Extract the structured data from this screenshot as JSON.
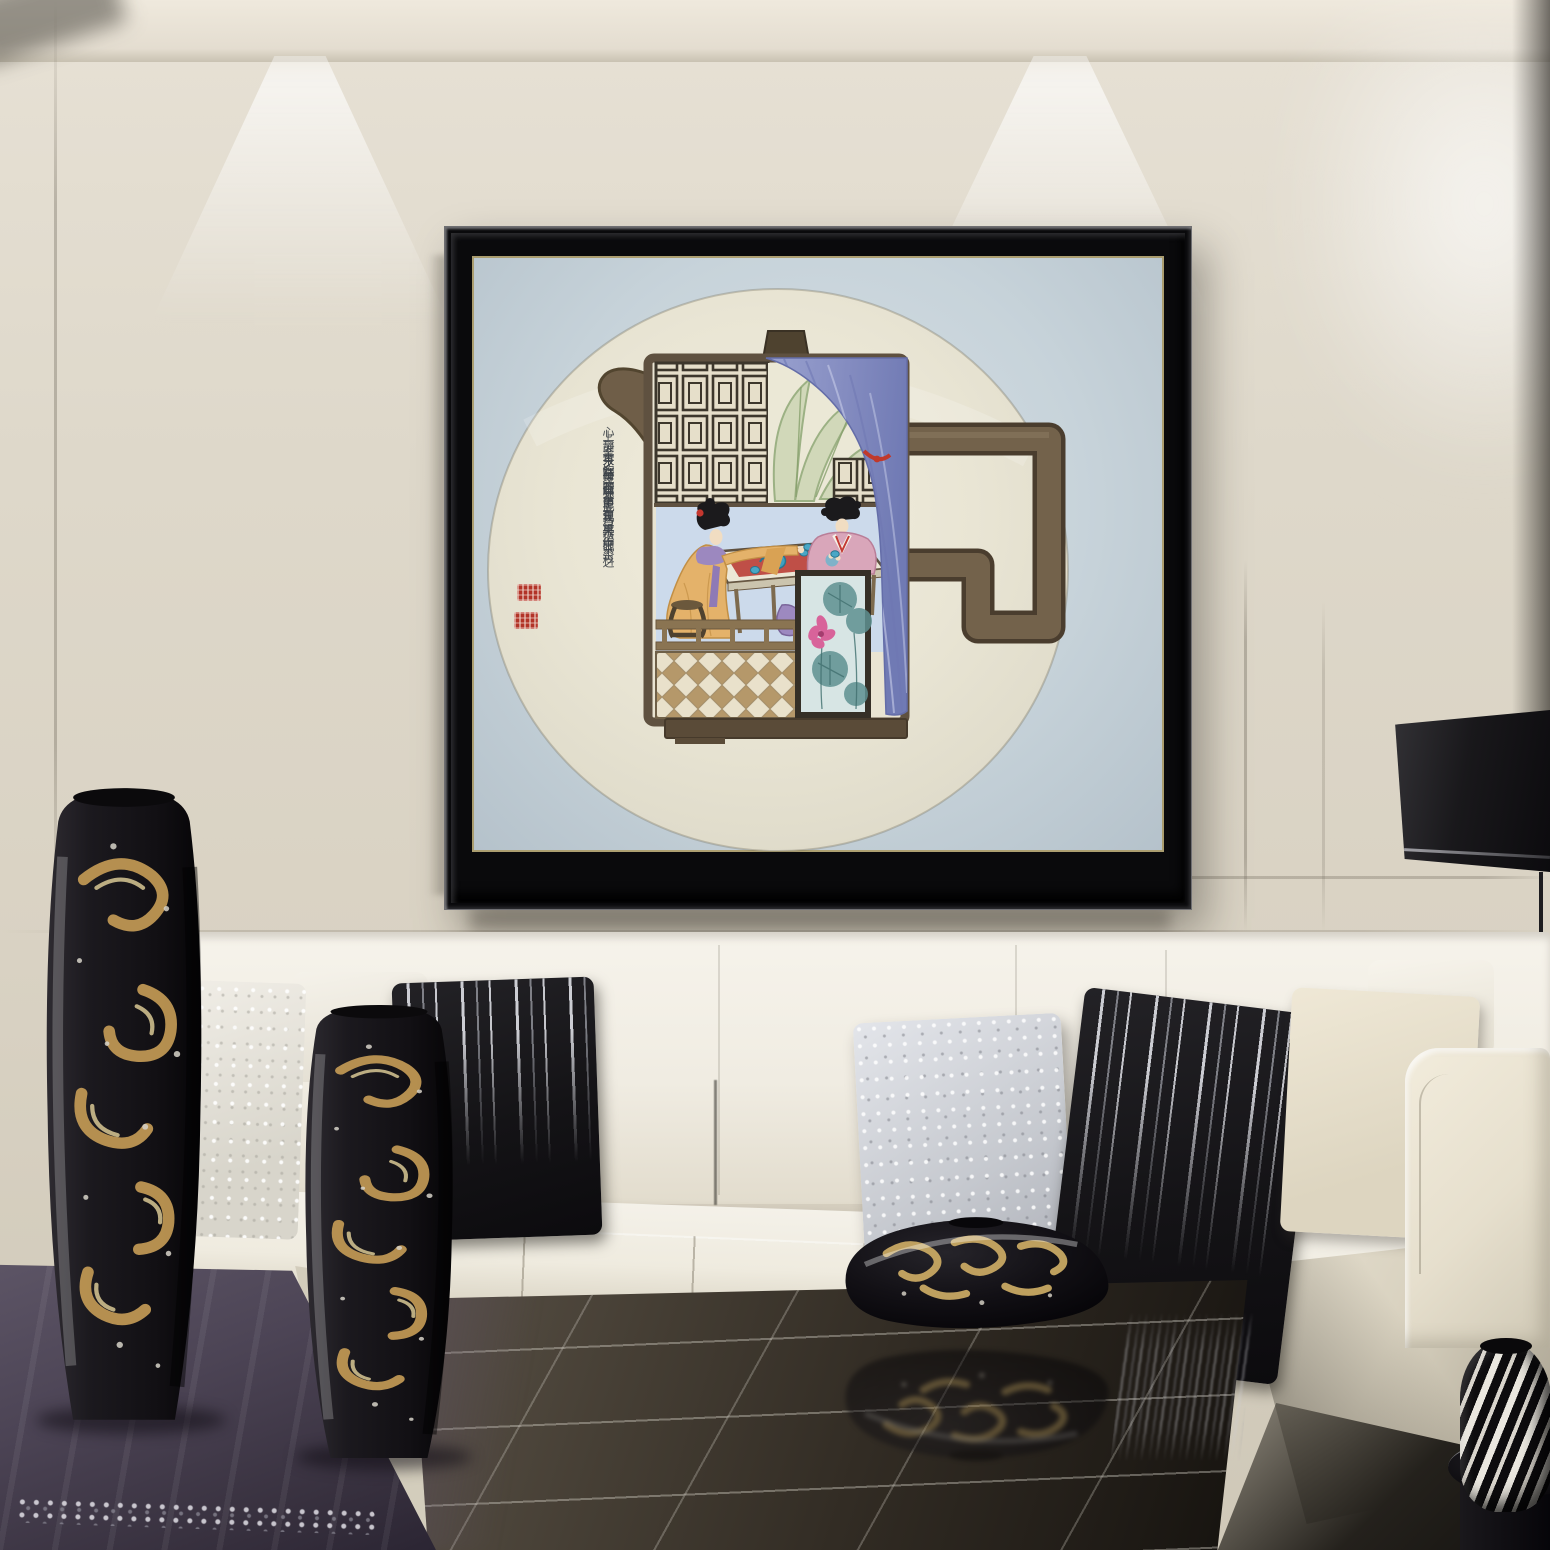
{
  "artwork": {
    "format": "round-silk-fan-painting",
    "subject": "teapot-shaped tea scene with two ladies",
    "calligraphy_columns": [
      "心靜茶至茶至灵来",
      "灵来神往道现其中",
      "善饮心茶者最得茶",
      "之三味此乃饮茶之",
      "上上之境界",
      "時丙申年",
      "砚科"
    ],
    "seals": [
      "artist-seal-icon",
      "artist-seal-icon"
    ]
  },
  "palette": {
    "wall": "#ddd6c8",
    "ceiling": "#e9e3d7",
    "frame_black": "#0a0a0c",
    "mat_blue": "#c7d3da",
    "fan_silk": "#eae6d6",
    "teapot_brown": "#6b5a44",
    "curtain_blue": "#8d95c7",
    "curtain_tie_red": "#c0392b",
    "lattice_cream": "#e6dfca",
    "leaf_green": "#a8bb8c",
    "tea_table_red": "#c05048",
    "teapot_teal": "#3f9fc0",
    "robe_orange": "#e4b26a",
    "robe_pink": "#d9a6ba",
    "shawl_purple": "#9c88bf",
    "checker_tan": "#b5986a",
    "lotus_pink": "#d8639a",
    "lotus_leaf_teal": "#5f9191",
    "seal_red": "#b23327",
    "sofa_white": "#f2efe7",
    "pillow_black": "#16161a",
    "pillow_silver": "#d3d5d9",
    "vase_gold": "#c39a55",
    "cloth_purple": "#4c4455",
    "gloss_table": "#332c24"
  }
}
